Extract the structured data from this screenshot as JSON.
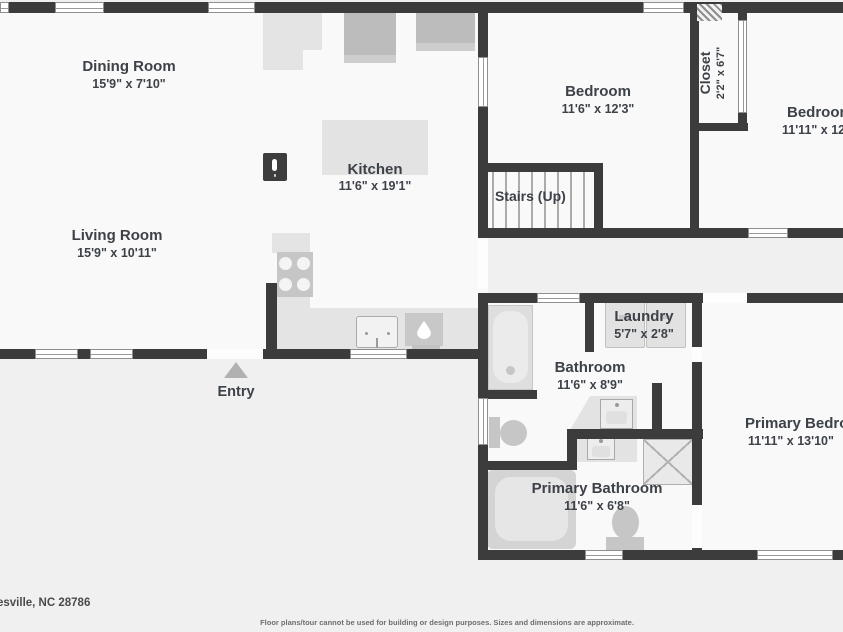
{
  "colors": {
    "wall": "#3c3c3c",
    "room_fill": "#f9f9f9",
    "exterior": "#f0f0f0",
    "counter": "#e4e4e4",
    "appliance": "#c6c6c6",
    "fridge": "#bcbcbc",
    "text": "#3d4148",
    "entry_marker": "#b1b1b1"
  },
  "rooms": {
    "dining": {
      "label": "Dining Room",
      "dims": "15'9\" x 7'10\""
    },
    "kitchen": {
      "label": "Kitchen",
      "dims": "11'6\" x 19'1\""
    },
    "living": {
      "label": "Living Room",
      "dims": "15'9\" x 10'11\""
    },
    "bedroom1": {
      "label": "Bedroom",
      "dims": "11'6\" x 12'3\""
    },
    "closet": {
      "label": "Closet",
      "dims": "2'2\" x 6'7\""
    },
    "bedroom2": {
      "label": "Bedroom",
      "dims": "11'11\" x 12'"
    },
    "stairs": {
      "label": "Stairs (Up)"
    },
    "laundry": {
      "label": "Laundry",
      "dims": "5'7\" x 2'8\""
    },
    "bathroom": {
      "label": "Bathroom",
      "dims": "11'6\" x 8'9\""
    },
    "primary_bathroom": {
      "label": "Primary Bathroom",
      "dims": "11'6\" x 6'8\""
    },
    "primary_bedroom": {
      "label": "Primary Bedroom",
      "dims": "11'11\" x 13'10\""
    },
    "entry": {
      "label": "Entry"
    }
  },
  "icons": {
    "tour_camera": "tour-camera-icon",
    "entry_marker": "entry-marker-icon",
    "water_drop": "water-drop-icon"
  },
  "footer": {
    "address": "esville, NC 28786",
    "disclaimer": "Floor plans/tour cannot be used for building or design purposes. Sizes and dimensions are approximate."
  }
}
